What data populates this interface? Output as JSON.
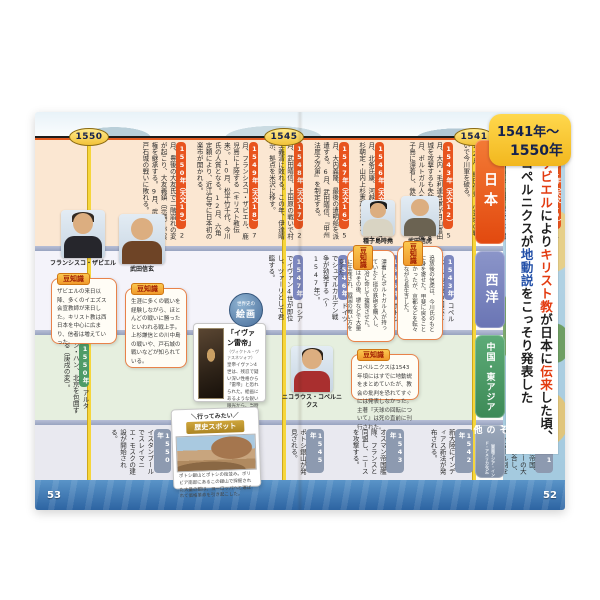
{
  "page_range_badge": {
    "line1": "1541年〜",
    "line2": "1550年"
  },
  "timeline_badges": {
    "b1550": "1550",
    "b1545": "1545",
    "b1541": "1541"
  },
  "headline": {
    "l1": {
      "s0": "ザビエル",
      "s1": "により",
      "s2": "キリスト教",
      "s3": "が日本に",
      "s4": "伝来",
      "s5": "した頃、"
    },
    "l2": {
      "s0": "コペルニクスが",
      "s1": "地動説",
      "s2": "をこっそり発表した"
    }
  },
  "rows": {
    "japan": {
      "label": "日本",
      "entries": [
        {
          "year": "1541年（天文10）",
          "text": "1月、毛利元就、安芸郡山城に尼子軍を撃退する。6月、武田晴信、父の信虎を追放する。"
        },
        {
          "year": "1542年（天文11）",
          "text": "7月、武田晴信、信濃に侵攻し、諏訪氏を滅ぼす。8月、斎藤道三、守護の土岐頼芸を追放する。12月、織田信秀、小豆坂の戦いで今川軍を破る。"
        },
        {
          "year": "1543年（天文12）",
          "text": "5月、大内・毛利連合軍が月山富田城を攻撃するも失敗に終わる。8月、ポルトガル人を乗せた船が種子島に漂着し、鉄砲が伝来する。"
        },
        {
          "year": "1546年（天文15）",
          "text": "4月、北条氏康、河越夜戦で扇谷上杉朝定・山内上杉憲政らを破る。"
        },
        {
          "year": "1547年（天文16）",
          "text": "5月、大内義隆、最後の遣明船を派遣する。6月、武田晴信、『甲州法度之次第』を制定する。"
        },
        {
          "year": "1548年（天文17）",
          "text": "2月、武田晴信、上田原の戦いで村上義清に敗れる。この年、伊達晴宗、拠点を米沢に移す。"
        },
        {
          "year": "1549年（天文18）",
          "text": "7月、フランシスコ・ザビエル、鹿児島に上陸する（キリスト教伝来）。10月、松平竹千代、今川氏の人質となる。12月、六角定頼により、近江石寺に日本初の楽市が開かれる。"
        },
        {
          "year": "1550年（天文19）",
          "text": "2月、豊後の大友氏で二階崩れの変が起こり、大友義鎮（宗麟）が実権を継承する。9月、武田晴信、戸石城の戦いに敗れる。"
        }
      ]
    },
    "west": {
      "label": "西洋",
      "entries": [
        {
          "year": "1541年",
          "text": "ハンガリーが三分割される。"
        },
        {
          "year": "1543年",
          "text": "コペルニクス『天球の回転について』が刊行される。"
        },
        {
          "year": "1545年",
          "text": "ポトシ銀山の開発が始まる。反宗教改革のトリエント公会議が始まる。"
        },
        {
          "year": "1546年",
          "text": "ドイツでシュマルカルデン戦争が勃発する（〜1547年）。"
        },
        {
          "year": "1547年",
          "text": "ロシアでイヴァン4世が即位し、ツァーリとして君臨する。"
        }
      ]
    },
    "china": {
      "label": "中国・東アジア",
      "entries": [
        {
          "year": "1550年",
          "text": "アルタン・ハン、北京を包囲する（庚戌の変）。"
        }
      ]
    },
    "other": {
      "label": "その他",
      "sublabel": "（東南アジア・インド・アメリカなど）",
      "entries": [
        {
          "year": "1541年",
          "text": "オスマン帝国、ハンガリーの大部分を併合し、ティマール制を敷く。ピサロ、暗殺される。"
        },
        {
          "year": "1542年",
          "text": "新大陸にインディアス新法が発布される。"
        },
        {
          "year": "1543年",
          "text": "オスマン帝国艦隊、フランスと同盟し、ニースを攻撃する。"
        },
        {
          "year": "1545年",
          "text": "ポトシ銀山が発見される。"
        },
        {
          "year": "1549年",
          "text": "ポルトガル、ブラジルに総督を置く。"
        },
        {
          "year": "1550年",
          "text": "イスタンブールでスレイマニエ・モスクの建設が開始される。"
        }
      ]
    }
  },
  "portraits": [
    {
      "name": "フランシスコ・ザビエル"
    },
    {
      "name": "武田信玄"
    },
    {
      "name": "種子島時堯"
    },
    {
      "name": "武田信虎"
    },
    {
      "name": "ニコラウス・コペルニクス"
    }
  ],
  "trivia": {
    "tag": "豆知識",
    "xavier": "ザビエルの来日以降、多くのイエズス会宣教師が来日した。キリスト教は西日本を中心に広まり、信者は増えていった。",
    "shingen": "生涯に多くの戦いを経験しながら、ほとんどの戦いに勝ったといわれる戦上手。上杉謙信との川中島の戦いや、戸石城の戦いなどが知られている。",
    "tokitaka": "漂着したポルトガル人が持っていた2挺の鉄砲を購入し、刀鍛冶に命じて複製させた。鉄砲はその後、堺などで大量に生産され、戦国の戦い方を変えた。",
    "nobutora": "追放後の信虎は、今川氏のもとに身を寄せた。甲斐に戻ることはなかったが、京都などを転々としながら長生きした。",
    "copernicus": "コペルニクスは1543年頃にはすでに地動説をまとめていたが、教会の批判を恐れてすぐには発表しなかった。主著『天球の回転について』は死の直前に刊行された。"
  },
  "painting_card": {
    "badge_top": "世界史の",
    "badge_main": "絵画",
    "title": "「イヴァン雷帝」",
    "artist": "（ヴィクトル・ヴァスネツォフ）",
    "caption": "皇帝イヴァン4世は、残忍で疑い深い性格から「雷帝」と恐れられた。絵画にあるような鋭い眼光から、当時の人々の恐れが伝わってくる。"
  },
  "spot_card": {
    "handwrite": "＼行ってみたい／",
    "ribbon": "歴史スポット",
    "caption": "ポトシ銀山とポトシの街並み。ボリビア南部にあるこの銀山で採掘された大量の銀は、ヨーロッパへと運ばれて価格革命を引き起こした。"
  },
  "page_numbers": {
    "left": "53",
    "right": "52"
  }
}
